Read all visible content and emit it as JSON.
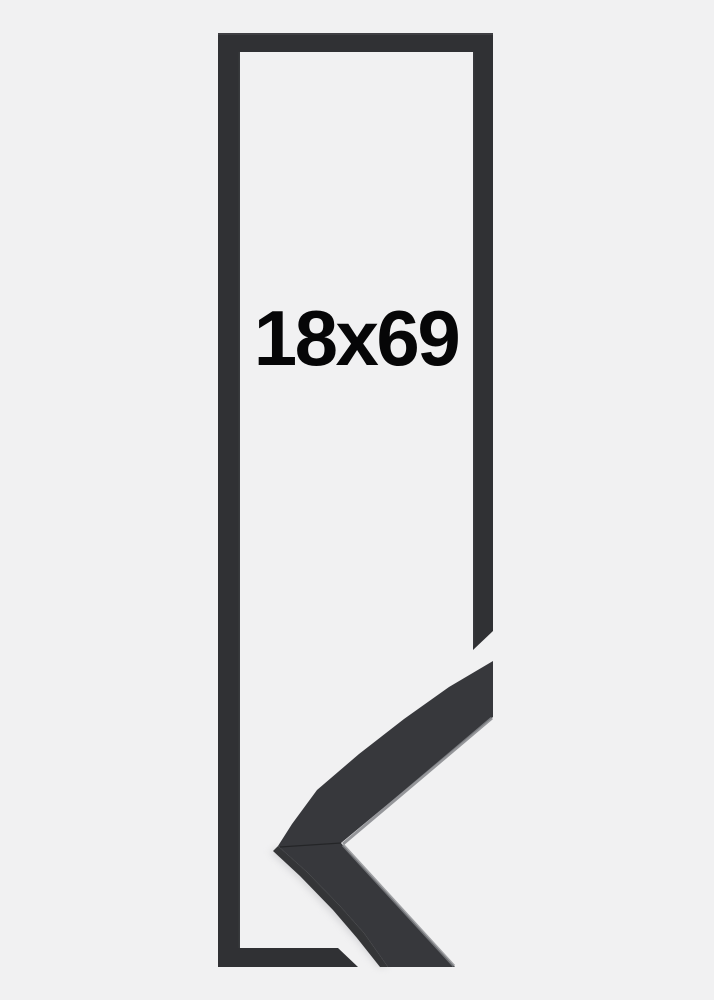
{
  "product": {
    "size_label": "18x69"
  },
  "colors": {
    "background": "#f1f1f2",
    "frame_outline": "#303134",
    "outline_edge_sheen": "#4d4e52",
    "photo_face": "#37383c",
    "photo_side": "#212225",
    "edge_highlight": "#85878b",
    "miter_seam": "#1a1b1d",
    "shadow": "#d5d5d8",
    "label_text": "#060607"
  }
}
